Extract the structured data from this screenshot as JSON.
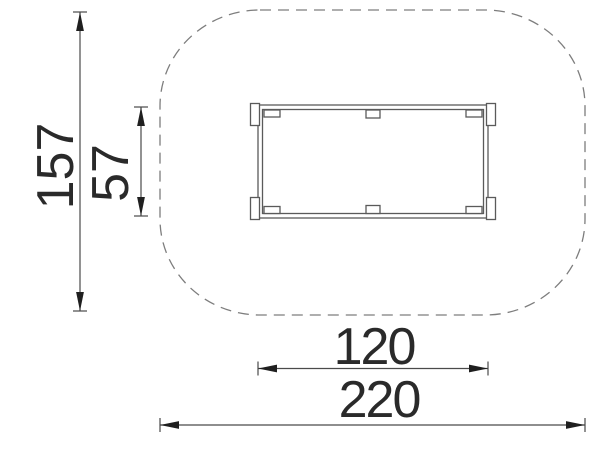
{
  "drawing": {
    "view": "top view technical drawing with safety zone",
    "dimensions": {
      "overall_height": "157",
      "item_depth": "57",
      "item_width": "120",
      "overall_width": "220"
    }
  },
  "colors": {
    "background": "#ffffff",
    "dimension_text": "#2a2a2a",
    "dimension_line": "#4a4a4a",
    "arrowhead": "#1f1f1f",
    "object_line": "#5a5a5a",
    "object_fill": "#ffffff",
    "safety_zone_dash": "#7d7d7d"
  }
}
